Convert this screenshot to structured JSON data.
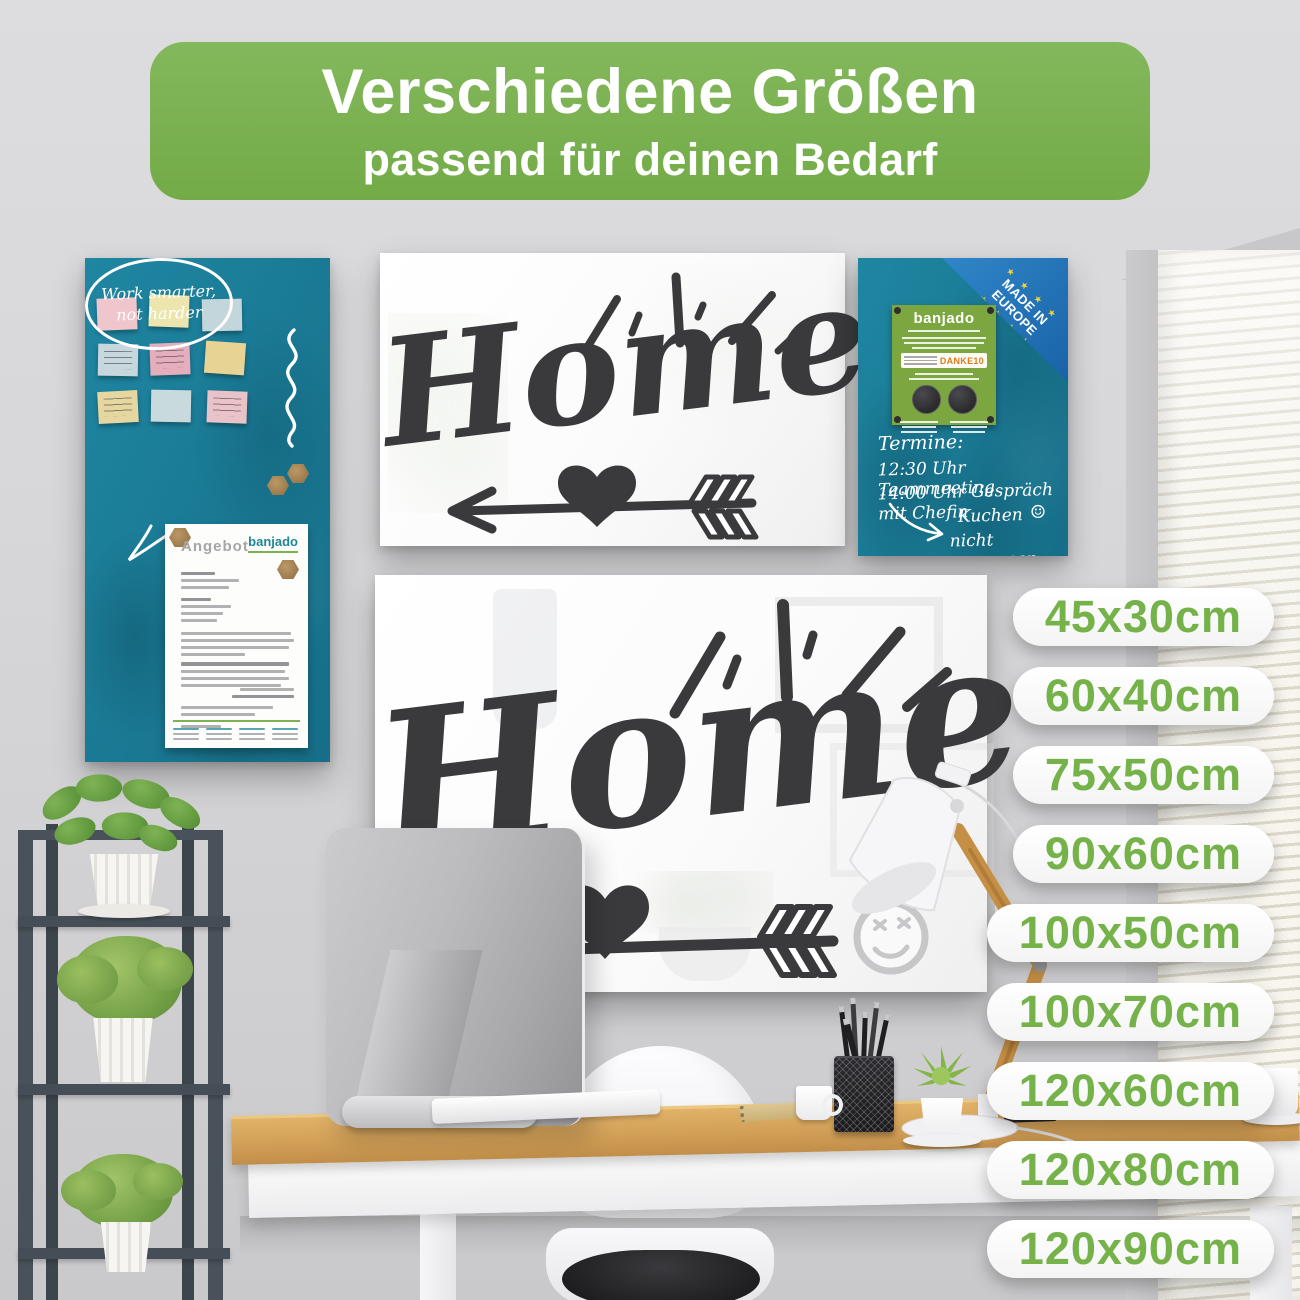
{
  "header": {
    "title": "Verschiedene Größen",
    "subtitle": "passend für deinen Bedarf"
  },
  "memo_board": {
    "speech_bubble": {
      "line1": "Work smarter,",
      "line2": "not harder"
    },
    "document": {
      "title": "Angebot",
      "brand": "banjado"
    }
  },
  "home_board_small": {
    "word": "Home"
  },
  "home_board_large": {
    "word": "Home"
  },
  "planner_board": {
    "ribbon": {
      "line1": "MADE IN",
      "line2": "EUROPE"
    },
    "flyer": {
      "brand": "banjado",
      "coupon": "DANKE10"
    },
    "schedule": {
      "line1": "Termine:",
      "line2": "12:30 Uhr Teammeeting",
      "line3": "14:00 Uhr Gespräch mit Chefin"
    },
    "reminder": {
      "word1": "Kuchen",
      "smiley": "☺",
      "word2": "nicht vergessen"
    }
  },
  "size_badges": {
    "items": [
      "45x30cm",
      "60x40cm",
      "75x50cm",
      "90x60cm",
      "100x50cm",
      "100x70cm",
      "120x60cm",
      "120x80cm",
      "120x90cm"
    ]
  },
  "colors": {
    "header_green": "#7cb251",
    "badge_text_green": "#76b24a",
    "board_teal": "#1b7b97",
    "ribbon_blue": "#1e6eb4",
    "flyer_green": "#7ca63f",
    "eu_star_yellow": "#f6d32d",
    "lettering_dark": "#3a3a3c"
  }
}
